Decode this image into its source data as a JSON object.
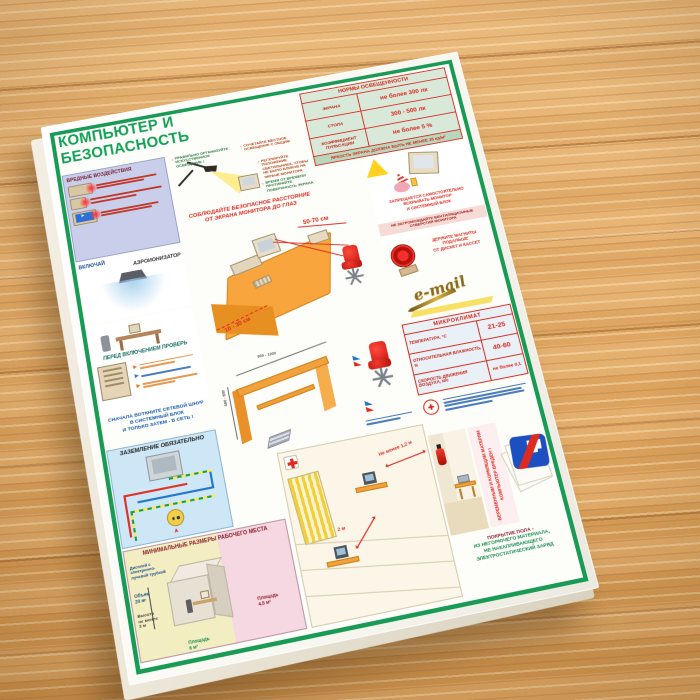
{
  "poster": {
    "title": "КОМПЬЮТЕР И БЕЗОПАСНОСТЬ",
    "colors": {
      "green": "#12a156",
      "red": "#e0281e",
      "orange": "#f7a53c",
      "blue": "#1258a8"
    },
    "norms": {
      "title": "НОРМЫ ОСВЕЩЕННОСТИ",
      "rows": [
        {
          "label": "ЭКРАНА",
          "value": "не более 300 лк"
        },
        {
          "label": "СТОЛА",
          "value": "300 - 500 лк"
        },
        {
          "label": "КОЭФФИЦИЕНТ ПУЛЬСАЦИИ",
          "value": "не более 5 %"
        }
      ],
      "footer": "ЯРКОСТЬ ЭКРАНА ДОЛЖНА БЫТЬ НЕ МЕНЕЕ 35 кд/м²"
    },
    "left": {
      "harmful_title": "ВРЕДНЫЕ ВОЗДЕЙСТВИЯ",
      "ionizer_action": "ВКЛЮЧАЙ",
      "ionizer_device": "АЭРОИОНИЗАТОР",
      "check_title": "ПЕРЕД ВКЛЮЧЕНИЕМ ПРОВЕРЬ",
      "plug_note": "СНАЧАЛА ВОТКНИТЕ СЕТЕВОЙ ШНУР\nВ СИСТЕМНЫЙ БЛОК\nИ ТОЛЬКО ЗАТЕМ - В СЕТЬ !",
      "grounding_title": "ЗАЗЕМЛЕНИЕ ОБЯЗАТЕЛЬНО",
      "minsize_title": "МИНИМАЛЬНЫЕ РАЗМЕРЫ РАБОЧЕГО МЕСТА",
      "minsize_crt": "Дисплей с электронно-\nлучевой трубкой",
      "minsize_volume": "Объем\n20 м³",
      "minsize_height": "Высота\nне менее\n3 м",
      "minsize_area": "Площадь\n6 м²",
      "minsize_lcd_area": "Площадь\n4,5 м²"
    },
    "center": {
      "tips": [
        "ПРАВИЛЬНО ОРГАНИЗУЙТЕ ИСКУССТВЕННОЕ ОСВЕЩЕНИЕ !",
        "СОЧЕТАЙТЕ МЕСТНОЕ ОСВЕЩЕНИЕ С ОБЩИМ",
        "РЕГУЛИРУЙТЕ ПОЛОЖЕНИЕ СВЕТИЛЬНИКА, ЧТОБЫ НЕ БЫЛО БЛИКОВ НА ЭКРАНЕ МОНИТОРА",
        "ВРЕМЯ ОТ ВРЕМЕНИ ПРОТИРАЙТЕ ПОВЕРХНОСТЬ ЭКРАНА"
      ],
      "banner": "СОБЛЮДАЙТЕ БЕЗОПАСНОЕ РАССТОЯНИЕ\nОТ ЭКРАНА МОНИТОРА ДО ГЛАЗ",
      "eye_distance": "50-70 см",
      "keyboard_distance": "10 - 30 см",
      "desk_width": "800 - 1200",
      "desk_height": "680 - 800",
      "room_gap_row": "2 м",
      "room_gap_side": "Не менее 1,2 м"
    },
    "right": {
      "forbid_text": "ЗАПРЕЩАЕТСЯ САМОСТОЯТЕЛЬНО\nВСКРЫВАТЬ МОНИТОР\nИ СИСТЕМНЫЙ БЛОК",
      "vent_text": "НЕ ЗАГРОМОЖДАЙТЕ ВЕНТИЛЯЦИОННЫЕ\nОТВЕРСТИЯ МОНИТОРА",
      "magnet_text": "ДЕРЖИТЕ МАГНИТЫ\nПОДАЛЬШЕ\nОТ ДИСКЕТ И КАССЕТ",
      "email_text": "e-mail",
      "climate": {
        "title": "МИКРОКЛИМАТ",
        "rows": [
          {
            "label": "ТЕМПЕРАТУРА, °С",
            "value": "21-25"
          },
          {
            "label": "ОТНОСИТЕЛЬНАЯ ВЛАЖНОСТЬ, %",
            "value": "40-60"
          },
          {
            "label": "СКОРОСТЬ ДВИЖЕНИЯ ВОЗДУХА, м/с",
            "value": "не более 0,1"
          }
        ]
      },
      "pregnant_text": "БЕРЕМЕННЫМ И КОРМЯЩИМ МАТЕРЯМ КОМПЬЮТЕР ВРЕДЕН !",
      "floor_prefix": "ПОКРЫТИЕ ПОЛА -",
      "floor_line1": "ИЗ НЕГОРЮЧЕГО МАТЕРИАЛА,",
      "floor_line2": "НЕ НАКАПЛИВАЮЩЕГО ЭЛЕКТРОСТАТИЧЕСКИЙ ЗАРЯД"
    }
  }
}
